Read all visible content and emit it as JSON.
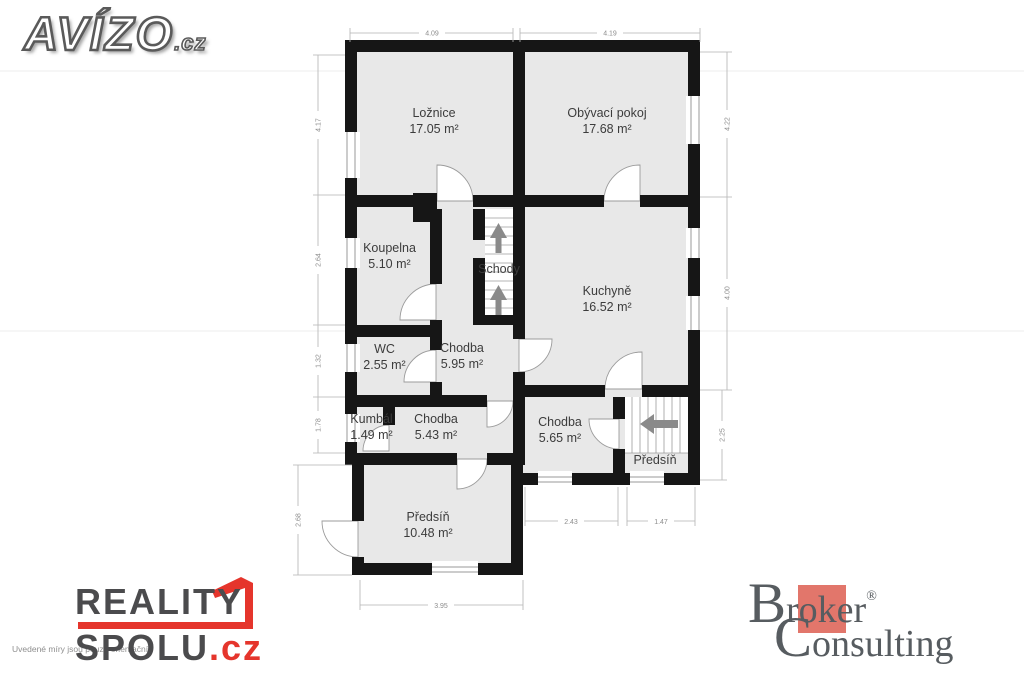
{
  "branding": {
    "avizo": {
      "name": "AVÍZO",
      "tld": ".cz"
    },
    "reality_spolu": {
      "line1": "REALITY",
      "line2": "SPOLU",
      "tld": ".cz",
      "accent": "#e5352c"
    },
    "broker_consulting": {
      "word1_big": "B",
      "word1_rest": "roker",
      "registered": "®",
      "word2_big": "C",
      "word2_rest": "onsulting",
      "square_color": "#e2766b"
    },
    "disclaimer": "Uvedené míry jsou pouze orientační."
  },
  "floorplan": {
    "rooms": [
      {
        "name": "Ložnice",
        "area": "17.05 m²"
      },
      {
        "name": "Obývací pokoj",
        "area": "17.68 m²"
      },
      {
        "name": "Koupelna",
        "area": "5.10 m²"
      },
      {
        "name": "Schody",
        "area": ""
      },
      {
        "name": "Kuchyně",
        "area": "16.52 m²"
      },
      {
        "name": "WC",
        "area": "2.55 m²"
      },
      {
        "name": "Chodba",
        "area": "5.95 m²"
      },
      {
        "name": "Kumbál",
        "area": "1.49 m²"
      },
      {
        "name": "Chodba",
        "area": "5.43 m²"
      },
      {
        "name": "Chodba",
        "area": "5.65 m²"
      },
      {
        "name": "Předsíň",
        "area": ""
      },
      {
        "name": "Předsíň",
        "area": "10.48 m²"
      }
    ],
    "dimensions": {
      "top": [
        "4.09",
        "4.19"
      ],
      "left": [
        "4.17",
        "2.64",
        "1.32",
        "1.78",
        "2.68"
      ],
      "right": [
        "4.22",
        "4.00",
        "2.25"
      ],
      "bottom_inner": [
        "2.43",
        "1.47"
      ],
      "bottom": [
        "3.95"
      ]
    }
  }
}
